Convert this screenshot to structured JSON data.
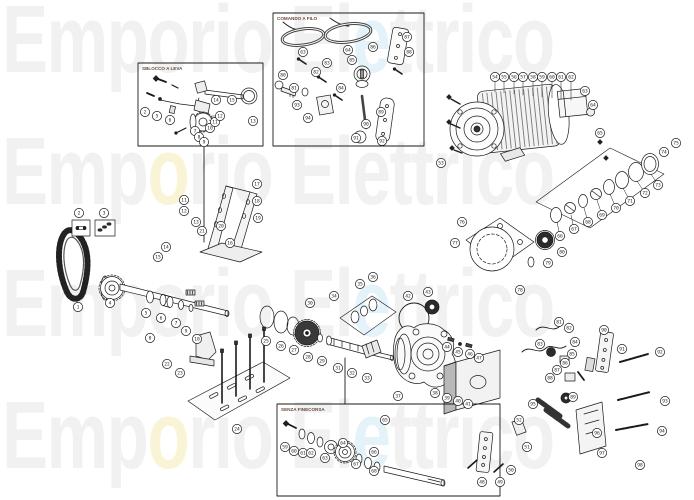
{
  "page": {
    "background": "#ffffff",
    "description": "exploded spare-parts diagram"
  },
  "watermark": {
    "rows": [
      {
        "top": -8,
        "segments": [
          {
            "text": "Emporio El",
            "color": "#f1f1f1"
          },
          {
            "text": "e",
            "color": "#e4f2fa"
          },
          {
            "text": "ttrico",
            "color": "#f1f1f1"
          }
        ]
      },
      {
        "top": 124,
        "segments": [
          {
            "text": "Emp",
            "color": "#f1f1f1"
          },
          {
            "text": "o",
            "color": "#faf4d6"
          },
          {
            "text": "rio Elettrico",
            "color": "#f1f1f1"
          }
        ]
      },
      {
        "top": 256,
        "segments": [
          {
            "text": "Emporio El",
            "color": "#f1f1f1"
          },
          {
            "text": "e",
            "color": "#e4f2fa"
          },
          {
            "text": "ttrico",
            "color": "#f1f1f1"
          }
        ]
      },
      {
        "top": 388,
        "segments": [
          {
            "text": "Emp",
            "color": "#f1f1f1"
          },
          {
            "text": "o",
            "color": "#faf4d6"
          },
          {
            "text": "rio El",
            "color": "#f1f1f1"
          },
          {
            "text": "e",
            "color": "#e4f2fa"
          },
          {
            "text": "ttrico",
            "color": "#f1f1f1"
          }
        ]
      }
    ]
  },
  "insets": [
    {
      "id": "sblocco",
      "label": "SBLOCCO A LEVA"
    },
    {
      "id": "comando",
      "label": "COMANDO A FILO"
    },
    {
      "id": "finecorsa",
      "label": "SENZA FINECORSA"
    }
  ],
  "style": {
    "line": "#1a1a1a",
    "dark": "#2b2b2b",
    "label_color": "#6b4a3a",
    "callout_fill": "#ffffff"
  },
  "callouts": [
    {
      "n": 1,
      "x": 78,
      "y": 307
    },
    {
      "n": 2,
      "x": 79,
      "y": 213
    },
    {
      "n": 3,
      "x": 104,
      "y": 213
    },
    {
      "n": 4,
      "x": 110,
      "y": 303
    },
    {
      "n": 5,
      "x": 146,
      "y": 313
    },
    {
      "n": 6,
      "x": 161,
      "y": 318
    },
    {
      "n": 7,
      "x": 176,
      "y": 323
    },
    {
      "n": 8,
      "x": 150,
      "y": 338
    },
    {
      "n": 9,
      "x": 186,
      "y": 331
    },
    {
      "n": 10,
      "x": 197,
      "y": 339
    },
    {
      "n": 11,
      "x": 184,
      "y": 200
    },
    {
      "n": 12,
      "x": 184,
      "y": 211
    },
    {
      "n": 13,
      "x": 196,
      "y": 222
    },
    {
      "n": 14,
      "x": 166,
      "y": 247
    },
    {
      "n": 15,
      "x": 158,
      "y": 257
    },
    {
      "n": 16,
      "x": 230,
      "y": 243
    },
    {
      "n": 17,
      "x": 257,
      "y": 184
    },
    {
      "n": 18,
      "x": 257,
      "y": 201
    },
    {
      "n": 19,
      "x": 258,
      "y": 218
    },
    {
      "n": 20,
      "x": 221,
      "y": 226
    },
    {
      "n": 21,
      "x": 202,
      "y": 231
    },
    {
      "n": 22,
      "x": 167,
      "y": 364
    },
    {
      "n": 23,
      "x": 180,
      "y": 373
    },
    {
      "n": 24,
      "x": 237,
      "y": 429
    },
    {
      "n": 25,
      "x": 266,
      "y": 341
    },
    {
      "n": 26,
      "x": 281,
      "y": 346
    },
    {
      "n": 27,
      "x": 294,
      "y": 350
    },
    {
      "n": 28,
      "x": 308,
      "y": 357
    },
    {
      "n": 29,
      "x": 322,
      "y": 361
    },
    {
      "n": 30,
      "x": 310,
      "y": 303
    },
    {
      "n": 31,
      "x": 338,
      "y": 368
    },
    {
      "n": 32,
      "x": 352,
      "y": 373
    },
    {
      "n": 33,
      "x": 367,
      "y": 378
    },
    {
      "n": 34,
      "x": 334,
      "y": 296
    },
    {
      "n": 35,
      "x": 360,
      "y": 284
    },
    {
      "n": 36,
      "x": 373,
      "y": 277
    },
    {
      "n": 37,
      "x": 398,
      "y": 396
    },
    {
      "n": 38,
      "x": 435,
      "y": 393
    },
    {
      "n": 39,
      "x": 447,
      "y": 398
    },
    {
      "n": 40,
      "x": 458,
      "y": 401
    },
    {
      "n": 41,
      "x": 468,
      "y": 404
    },
    {
      "n": 42,
      "x": 408,
      "y": 296
    },
    {
      "n": 43,
      "x": 428,
      "y": 292
    },
    {
      "n": 44,
      "x": 447,
      "y": 347
    },
    {
      "n": 45,
      "x": 458,
      "y": 352
    },
    {
      "n": 46,
      "x": 470,
      "y": 354
    },
    {
      "n": 47,
      "x": 479,
      "y": 358
    },
    {
      "n": 48,
      "x": 482,
      "y": 482
    },
    {
      "n": 49,
      "x": 500,
      "y": 482
    },
    {
      "n": 50,
      "x": 511,
      "y": 470
    },
    {
      "n": 51,
      "x": 527,
      "y": 447
    },
    {
      "n": 52,
      "x": 519,
      "y": 420
    },
    {
      "n": 53,
      "x": 441,
      "y": 163
    },
    {
      "n": 54,
      "x": 495,
      "y": 77,
      "lx": 495,
      "ly": 92
    },
    {
      "n": 55,
      "x": 504,
      "y": 77,
      "lx": 504,
      "ly": 93
    },
    {
      "n": 56,
      "x": 514,
      "y": 77,
      "lx": 514,
      "ly": 94
    },
    {
      "n": 57,
      "x": 523,
      "y": 77,
      "lx": 523,
      "ly": 95
    },
    {
      "n": 58,
      "x": 533,
      "y": 77,
      "lx": 533,
      "ly": 96
    },
    {
      "n": 59,
      "x": 542,
      "y": 77,
      "lx": 542,
      "ly": 97
    },
    {
      "n": 60,
      "x": 552,
      "y": 77,
      "lx": 552,
      "ly": 98
    },
    {
      "n": 61,
      "x": 561,
      "y": 77,
      "lx": 561,
      "ly": 99
    },
    {
      "n": 62,
      "x": 571,
      "y": 77,
      "lx": 571,
      "ly": 100
    },
    {
      "n": 63,
      "x": 585,
      "y": 91
    },
    {
      "n": 64,
      "x": 593,
      "y": 105
    },
    {
      "n": 65,
      "x": 600,
      "y": 133
    },
    {
      "n": 66,
      "x": 560,
      "y": 236,
      "lx": 557,
      "ly": 222
    },
    {
      "n": 67,
      "x": 574,
      "y": 229,
      "lx": 571,
      "ly": 215
    },
    {
      "n": 68,
      "x": 588,
      "y": 222,
      "lx": 584,
      "ly": 208
    },
    {
      "n": 69,
      "x": 602,
      "y": 215,
      "lx": 597,
      "ly": 200
    },
    {
      "n": 70,
      "x": 616,
      "y": 208,
      "lx": 610,
      "ly": 194
    },
    {
      "n": 71,
      "x": 630,
      "y": 201,
      "lx": 623,
      "ly": 188
    },
    {
      "n": 72,
      "x": 645,
      "y": 193,
      "lx": 637,
      "ly": 181
    },
    {
      "n": 73,
      "x": 658,
      "y": 185,
      "lx": 651,
      "ly": 174
    },
    {
      "n": 74,
      "x": 664,
      "y": 152
    },
    {
      "n": 75,
      "x": 676,
      "y": 143
    },
    {
      "n": 76,
      "x": 462,
      "y": 222
    },
    {
      "n": 77,
      "x": 455,
      "y": 243
    },
    {
      "n": 78,
      "x": 520,
      "y": 290
    },
    {
      "n": 79,
      "x": 548,
      "y": 263
    },
    {
      "n": 80,
      "x": 562,
      "y": 252
    },
    {
      "n": 81,
      "x": 559,
      "y": 322
    },
    {
      "n": 82,
      "x": 569,
      "y": 328
    },
    {
      "n": 83,
      "x": 540,
      "y": 344
    },
    {
      "n": 84,
      "x": 575,
      "y": 342
    },
    {
      "n": 85,
      "x": 572,
      "y": 354
    },
    {
      "n": 86,
      "x": 565,
      "y": 363
    },
    {
      "n": 87,
      "x": 557,
      "y": 370
    },
    {
      "n": 88,
      "x": 550,
      "y": 378
    },
    {
      "n": 89,
      "x": 573,
      "y": 397
    },
    {
      "n": 90,
      "x": 604,
      "y": 330
    },
    {
      "n": 91,
      "x": 622,
      "y": 349
    },
    {
      "n": 92,
      "x": 660,
      "y": 352
    },
    {
      "n": 93,
      "x": 665,
      "y": 401
    },
    {
      "n": 94,
      "x": 662,
      "y": 431
    },
    {
      "n": 95,
      "x": 533,
      "y": 404
    },
    {
      "n": 96,
      "x": 597,
      "y": 433
    },
    {
      "n": 97,
      "x": 602,
      "y": 453
    },
    {
      "n": 98,
      "x": 640,
      "y": 465
    },
    {
      "n": 2,
      "x": 145,
      "y": 112
    },
    {
      "n": 5,
      "x": 157,
      "y": 116
    },
    {
      "n": 6,
      "x": 170,
      "y": 120
    },
    {
      "n": 7,
      "x": 195,
      "y": 131
    },
    {
      "n": 8,
      "x": 199,
      "y": 137
    },
    {
      "n": 9,
      "x": 204,
      "y": 142
    },
    {
      "n": 10,
      "x": 210,
      "y": 128,
      "lx": 206,
      "ly": 124
    },
    {
      "n": 11,
      "x": 215,
      "y": 122,
      "lx": 209,
      "ly": 120
    },
    {
      "n": 12,
      "x": 220,
      "y": 116,
      "lx": 212,
      "ly": 116
    },
    {
      "n": 13,
      "x": 253,
      "y": 121
    },
    {
      "n": 14,
      "x": 216,
      "y": 100
    },
    {
      "n": 15,
      "x": 232,
      "y": 100
    },
    {
      "n": 63,
      "x": 303,
      "y": 52
    },
    {
      "n": 64,
      "x": 348,
      "y": 50
    },
    {
      "n": 80,
      "x": 283,
      "y": 75
    },
    {
      "n": 81,
      "x": 294,
      "y": 88
    },
    {
      "n": 82,
      "x": 316,
      "y": 72
    },
    {
      "n": 83,
      "x": 327,
      "y": 63
    },
    {
      "n": 84,
      "x": 341,
      "y": 88
    },
    {
      "n": 85,
      "x": 352,
      "y": 60
    },
    {
      "n": 86,
      "x": 373,
      "y": 47
    },
    {
      "n": 87,
      "x": 407,
      "y": 37
    },
    {
      "n": 88,
      "x": 409,
      "y": 52
    },
    {
      "n": 89,
      "x": 381,
      "y": 112
    },
    {
      "n": 90,
      "x": 366,
      "y": 124
    },
    {
      "n": 91,
      "x": 356,
      "y": 138
    },
    {
      "n": 92,
      "x": 382,
      "y": 141
    },
    {
      "n": 93,
      "x": 297,
      "y": 105
    },
    {
      "n": 94,
      "x": 308,
      "y": 118
    },
    {
      "n": 59,
      "x": 285,
      "y": 447
    },
    {
      "n": 60,
      "x": 294,
      "y": 451
    },
    {
      "n": 61,
      "x": 303,
      "y": 453
    },
    {
      "n": 62,
      "x": 311,
      "y": 453
    },
    {
      "n": 63,
      "x": 325,
      "y": 458
    },
    {
      "n": 64,
      "x": 343,
      "y": 443
    },
    {
      "n": 65,
      "x": 385,
      "y": 420
    },
    {
      "n": 66,
      "x": 374,
      "y": 452
    },
    {
      "n": 67,
      "x": 356,
      "y": 464
    },
    {
      "n": 68,
      "x": 374,
      "y": 471
    }
  ]
}
